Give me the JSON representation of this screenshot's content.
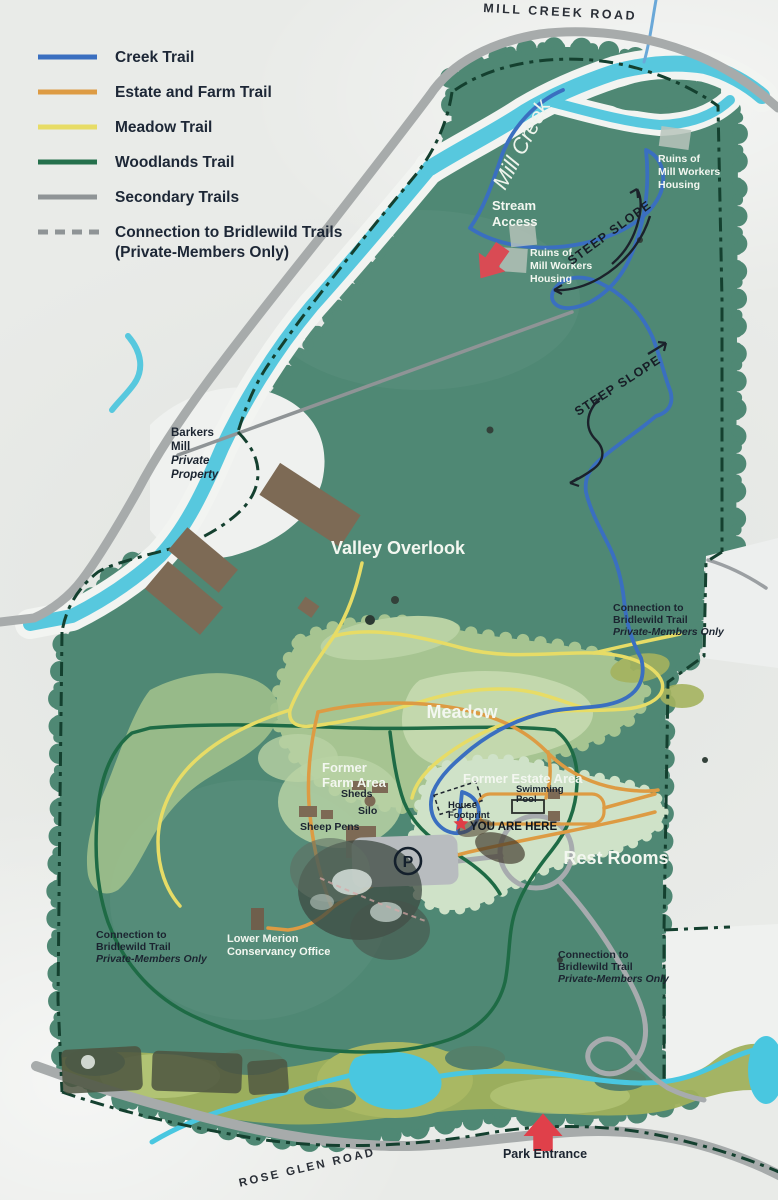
{
  "sign": {
    "title_note": "park trail map sign",
    "legend": {
      "items": [
        {
          "label": "Creek Trail",
          "color": "#3a6fc0",
          "style": "solid"
        },
        {
          "label": "Estate and Farm Trail",
          "color": "#dd9b43",
          "style": "solid"
        },
        {
          "label": "Meadow Trail",
          "color": "#e7dc66",
          "style": "solid"
        },
        {
          "label": "Woodlands Trail",
          "color": "#25704c",
          "style": "solid"
        },
        {
          "label": "Secondary Trails",
          "color": "#8f9496",
          "style": "solid"
        },
        {
          "label": "Connection to Bridlewild Trails",
          "label_line2": "(Private-Members Only)",
          "color": "#8f9496",
          "style": "dashed"
        }
      ]
    },
    "roads": {
      "mill_creek_road": "MILL CREEK ROAD",
      "rose_glen_road": "ROSE GLEN ROAD"
    },
    "water": {
      "mill_creek": "Mill Creek"
    },
    "annotations": {
      "stream_access": [
        "Stream",
        "Access"
      ],
      "ruins_ne": [
        "Ruins of",
        "Mill Workers",
        "Housing"
      ],
      "ruins_w": [
        "Ruins of",
        "Mill Workers",
        "Housing"
      ],
      "steep_slope_1": "STEEP SLOPE",
      "steep_slope_2": "STEEP SLOPE",
      "barkers_mill": [
        "Barkers",
        "Mill",
        "Private",
        "Property"
      ],
      "valley_overlook": "Valley Overlook",
      "meadow": "Meadow",
      "former_farm_area": [
        "Former",
        "Farm Area"
      ],
      "sheds": "Sheds",
      "silo": "Silo",
      "sheep_pens": "Sheep Pens",
      "former_estate_area": "Former Estate Area",
      "swimming_pool": [
        "Swimming",
        "Pool"
      ],
      "house_footprint": [
        "House",
        "Footprint"
      ],
      "you_are_here": "YOU ARE HERE",
      "rest_rooms": "Rest Rooms",
      "conservancy_office": [
        "Lower Merion",
        "Conservancy Office"
      ],
      "bridlewild_east": [
        "Connection to",
        "Bridlewild Trail",
        "Private-Members Only"
      ],
      "bridlewild_southwest": [
        "Connection to",
        "Bridlewild Trail",
        "Private-Members Only"
      ],
      "bridlewild_southeast": [
        "Connection to",
        "Bridlewild Trail",
        "Private-Members Only"
      ],
      "park_entrance": "Park Entrance",
      "parking_symbol": "P"
    },
    "colors": {
      "creek_trail": "#3a6fc0",
      "estate_farm_trail": "#dd9b43",
      "meadow_trail": "#e7dc66",
      "woodlands_trail": "#1e6b45",
      "secondary_trail": "#8f9496",
      "boundary": "#14402f",
      "forest": "#4f8874",
      "meadow_green": "#a6c491",
      "pale_green": "#cfe2c8",
      "olive": "#9fb05c",
      "creek_water": "#57c8de",
      "road_gray": "#a7abab",
      "building_brown": "#7d6a55",
      "marker_red": "#d94b54"
    }
  }
}
